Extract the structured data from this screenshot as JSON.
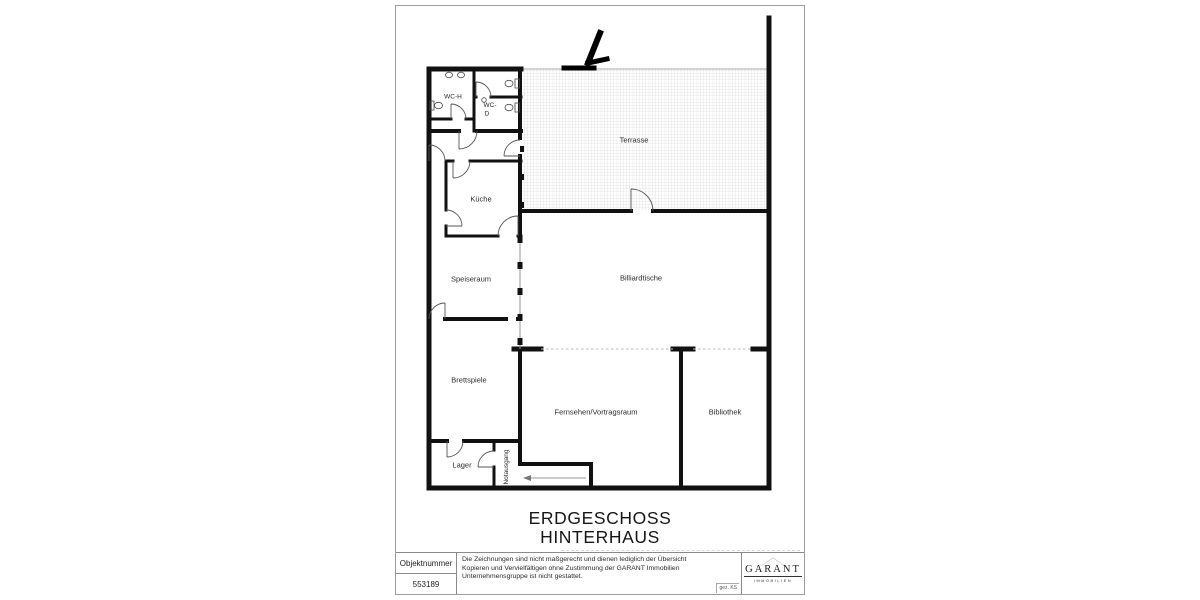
{
  "sheet": {
    "plan_title": [
      "ERDGESCHOSS",
      "HINTERHAUS"
    ]
  },
  "rooms": {
    "wc_h": "WC-H",
    "wc_d_lines": [
      "WC-",
      "D"
    ],
    "kueche": "Küche",
    "terrasse": "Terrasse",
    "speiseraum": "Speiseraum",
    "billiardtische": "Billiardtische",
    "brettspiele": "Brettspiele",
    "fernsehen_vortragsraum": "Fernsehen/Vortragsraum",
    "bibliothek": "Bibliothek",
    "lager": "Lager",
    "notausgang": "Notausgang"
  },
  "title_block": {
    "object_number_label": "Objektnummer",
    "object_number_value": "553189",
    "disclaimer_lines": [
      "Die Zeichnungen sind nicht maßgerecht und dienen lediglich der Übersicht",
      "Kopieren und Vervielfältigen ohne Zustimmung der GARANT Immobilien",
      "Unternehmensgruppe ist nicht gestattet."
    ],
    "drawn_by": "gez. KS",
    "logo_text": "GARANT",
    "logo_subtext": "IMMOBILIEN"
  },
  "colors": {
    "wall": "#111111",
    "hatch_line": "#c9c9c9",
    "dashed_partition": "#bbbbbb",
    "label": "#2b2b2b"
  }
}
